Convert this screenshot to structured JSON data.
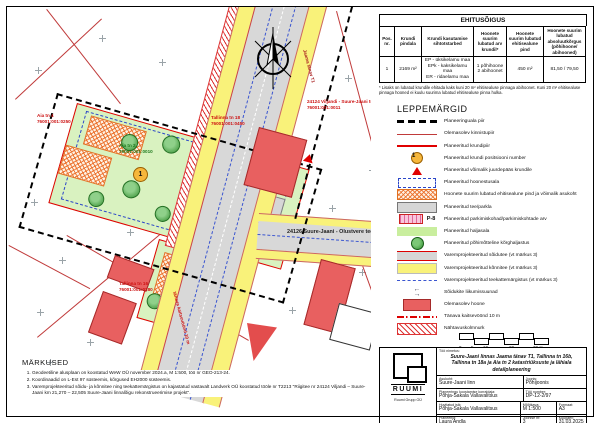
{
  "ehitusoigus": {
    "title": "EHITUSÕIGUS",
    "headers": [
      "Pos. nr.",
      "Krundi pindala",
      "Krundi kasutamise sihtotstarbed",
      "Hoonete suurim lubatud arv krundil*",
      "Hoonete suurim lubatud ehitisealune pind",
      "Hoonete suurim lubatud absoluutkõrgus (põhihoone/ abihooned)"
    ],
    "rows": [
      [
        "1",
        "2169 m²",
        "EP - üksikelamu maa\nEPk - kaksikelamu maa\nER - ridaelamu maa",
        "1 põhihoone\n2 abihoonet",
        "450 m²",
        "81,50 / 79,50"
      ]
    ],
    "footnote": "* Lisaks on lubatud krundile ehitada kaks kuni 20 m² ehitisealuse pinnaga abihoonet. Kuni 20 m² ehitisealuse pinnaga hooned ei kuulu suurima lubatud ehitisealuse pinna hulka."
  },
  "legend": {
    "title": "LEPPEMÄRGID",
    "items": [
      {
        "swatch": "plan-boundary",
        "label": "Planeeringuala piir"
      },
      {
        "swatch": "existing-boundary",
        "label": "Olemasolev kinnistupiir"
      },
      {
        "swatch": "plot-boundary",
        "label": "Planeeritud krundipiir"
      },
      {
        "swatch": "pos-number",
        "sample": "1",
        "label": "Planeeritud krundi positsiooni number"
      },
      {
        "swatch": "access",
        "label": "Planeeritud võimalik juurdepääs krundile"
      },
      {
        "swatch": "building-area",
        "label": "Planeeritud hoonestusala"
      },
      {
        "swatch": "building-footprint",
        "label": "Hoonete suurim lubatud ehitisealune pind ja võimalik asukoht"
      },
      {
        "swatch": "road-parking",
        "label": "Planeeritud tee/parkla"
      },
      {
        "swatch": "parking-count",
        "sample": "P-8",
        "label": "Planeeritud parkimiskohad/parkimiskohtade arv"
      },
      {
        "swatch": "green-area",
        "label": "Planeeritud haljasala"
      },
      {
        "swatch": "tall-greenery",
        "label": "Planeeritud põhimõtteline kõrghaljastus"
      },
      {
        "swatch": "prev-road",
        "label": "Varemprojekteeritud sõidutee (vt märkus 3)"
      },
      {
        "swatch": "prev-sidewalk",
        "label": "Varemprojekteeritud kõnnitee (vt märkus 3)"
      },
      {
        "swatch": "prev-marking",
        "label": "Varemprojekteeritud teekattemärgistus (vt märkus 3)"
      },
      {
        "swatch": "traffic-dir",
        "label": "Sõidukite liikumissuunad"
      },
      {
        "swatch": "existing-building",
        "label": "Olemasolev hoone"
      },
      {
        "swatch": "street-zone",
        "label": "Tänava kaitsevöönd 10 m"
      },
      {
        "swatch": "visibility",
        "label": "Nähtavuskolmnurk"
      }
    ]
  },
  "notes": {
    "title": "MÄRKUSED",
    "items": [
      "Geodeetiline alusplaan on koostatud WeW OÜ november 2024.a, M 1:500, töö nr GEO-213-24.",
      "Koordinaadid on L-Est 97 süsteemis, kõrgused EH2000 süsteemis.",
      "Varemprojekteeritud sõidu- ja kõnnitee ning teekattemärgistus on kajastatud vastavalt Landverk OÜ koostatud tööle nr T2213 \"Riigitee nr 24124 Viljandi – Suure-Jaani km 21,270 – 22,505 Suure-Jaani linnalõigu rekonstrueerimise projekt\"."
    ]
  },
  "scalebar": {
    "labels": [
      "0",
      "5",
      "10",
      "20",
      "30 m"
    ]
  },
  "titleblock": {
    "logo_name": "RUUMI",
    "logo_sub": "Ruumi Grupp OÜ",
    "work_title_label": "Töö nimetus:",
    "work_title": "Suure-Jaani linnas Jaama tänav T1, Tallinna tn 16b, Tallinna tn 18a ja Aia tn 2 katastriüksuste ja lähiala detailplaneering",
    "fields": [
      {
        "label": "Asukoht:",
        "value": "Suure-Jaani linn"
      },
      {
        "label": "Joonis:",
        "value": "Põhijoonis"
      },
      {
        "label": "Planeeringu koostamise korraldaja:",
        "value": "Põhja-Sakala Vallavalitsus"
      },
      {
        "label": "Töö number:",
        "value": "DP-12-2/97"
      },
      {
        "label": "Huvitatud isik:",
        "value": "Põhja-Sakala Vallavalitsus"
      },
      {
        "label": "Mõõtkava:",
        "value": "M 1:500"
      },
      {
        "label": "Formaat:",
        "value": "A3"
      },
      {
        "label": "Planeerija:",
        "value": "Laura Andla"
      },
      {
        "label": "Joonise nr:",
        "value": "3"
      },
      {
        "label": "Kuupäev:",
        "value": "31.03.2025"
      }
    ]
  },
  "map": {
    "pos_number": "1",
    "labels": [
      {
        "lines": [
          "Aia tn 4",
          "76001:001:0250"
        ],
        "color": "#cc1111"
      },
      {
        "lines": [
          "Tallinna tn 18",
          "76001:001:0450"
        ],
        "color": "#cc1111"
      },
      {
        "lines": [
          "Aia tn 2",
          "76001:001:0010"
        ],
        "color": "#1e7a1e"
      },
      {
        "lines": [
          "Tallinna tn 16",
          "76001:001:0280"
        ],
        "color": "#cc1111"
      },
      {
        "lines": [
          "24124 Viljandi - Suure-Jaani tee T4",
          "76001:001:0011"
        ],
        "color": "#cc1111"
      },
      {
        "lines": [
          "24126 Suure-Jaani - Olustvere tee"
        ],
        "color": "#222222"
      },
      {
        "lines": [
          "Jaama tänav T1"
        ],
        "color": "#aa2222"
      },
      {
        "lines": [
          "tänava kaitsevöönd 10 m"
        ],
        "color": "#cc1111"
      }
    ],
    "colors": {
      "parcel_green": "#d9f2c0",
      "sidewalk_yellow": "#f9f27a",
      "road_gray": "#d8d8d8",
      "building_red": "#e86060",
      "boundary_red": "#e00000",
      "hoonestus_blue": "#2b46c8",
      "footprint_orange": "#e07020",
      "pos_circle": "#f6b73c"
    }
  }
}
